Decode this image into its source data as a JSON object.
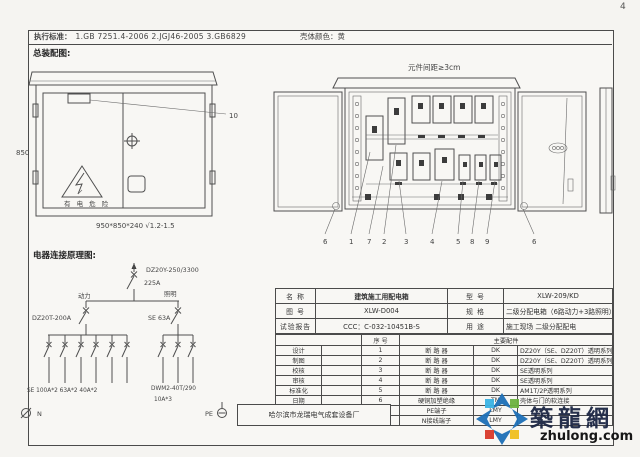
{
  "page": {
    "number": "4"
  },
  "header": {
    "standards_label": "执行标准：",
    "standards": "1.GB 7251.4-2006      2.JGJ46-2005      3.GB6829",
    "shell_color": "壳体颜色：黄"
  },
  "sections": {
    "assembly": "总装配图:",
    "schematic": "电器连接原理图:"
  },
  "assembly_drawing": {
    "height_dim": "850",
    "size_note": "950*850*240  √1.2-1.5",
    "warning_text": "有 电 危 险",
    "callout_10": "10"
  },
  "layout_drawing": {
    "spacing_note": "元件间距≥3cm",
    "callouts": [
      "6",
      "1",
      "7",
      "2",
      "3",
      "4",
      "5",
      "8",
      "9",
      "6"
    ]
  },
  "schematic": {
    "main_breaker_model": "DZ20Y-250/3300",
    "main_breaker_current": "225A",
    "branch_power": "动力",
    "branch_lighting": "照明",
    "power_breaker": "DZ20T-200A",
    "lighting_breaker": "SE  63A",
    "power_outputs": "SE  100A*2    63A*2    40A*2",
    "lighting_outputs_model": "DWM2-40T/290",
    "lighting_outputs_rating": "10A*3",
    "neutral_label": "N",
    "pe_label": "PE"
  },
  "spec_table": {
    "info_rows": [
      {
        "k1": "名 称",
        "v1": "建筑施工用配电箱",
        "k2": "型 号",
        "v2": "XLW-209/KD"
      },
      {
        "k1": "图 号",
        "v1": "XLW-D004",
        "k2": "规 格",
        "v2": "二级分配电箱（6路动力+3路照明）"
      },
      {
        "k1": "试验报告",
        "v1": "CCC：C-032-10451B-S",
        "k2": "用 途",
        "v2": "施工现场 二级分配配电"
      }
    ],
    "seq_header": "序 号",
    "parts_header": "主要配件",
    "parts": [
      {
        "role": "设计",
        "seq": "1",
        "name": "断 路 器",
        "code": "DK",
        "desc": "DZ20Y（SE、DZ20T）透明系列"
      },
      {
        "role": "制图",
        "seq": "2",
        "name": "断 路 器",
        "code": "DK",
        "desc": "DZ20Y（SE、DZ20T）透明系列"
      },
      {
        "role": "校核",
        "seq": "3",
        "name": "断 路 器",
        "code": "DK",
        "desc": "SE透明系列"
      },
      {
        "role": "审核",
        "seq": "4",
        "name": "断 路 器",
        "code": "DK",
        "desc": "SE透明系列"
      },
      {
        "role": "标准化",
        "seq": "5",
        "name": "断 路 器",
        "code": "DK",
        "desc": "AM1T/2P透明系列"
      },
      {
        "role": "日期",
        "seq": "6",
        "name": "硬铜加塑绝缘",
        "code": "TM",
        "desc": "壳体与门的软连接"
      },
      {
        "role": "",
        "seq": "7",
        "name": "PE端子",
        "code": "LMY",
        "desc": ""
      },
      {
        "role": "",
        "seq": "8",
        "name": "N接线端子",
        "code": "LMY",
        "desc": ""
      }
    ]
  },
  "company": "哈尔滨市龙瑞电气成套设备厂",
  "watermark": {
    "name": "築龍網",
    "domain": "zhulong.com"
  }
}
